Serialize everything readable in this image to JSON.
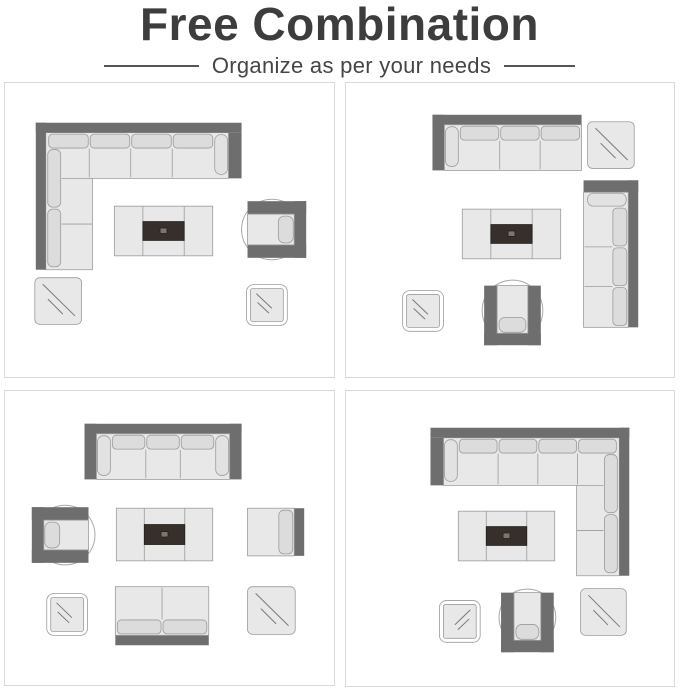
{
  "header": {
    "title": "Free Combination",
    "subtitle": "Organize as per your needs"
  },
  "colors": {
    "title": "#3d3d3d",
    "subtitle": "#454545",
    "divider": "#555555",
    "panel_border": "#d9d9d9",
    "background": "#ffffff",
    "frame_dark": "#6e6e6e",
    "seat_light": "#e8e8e8",
    "cushion_mid": "#dcdcdc",
    "arm_cushion": "#e2e2e2",
    "outline": "#9b9b9b",
    "circle_stroke": "#a8a8a8",
    "table_dark": "#362f2b",
    "table_dark_edge": "#242019",
    "table_icon": "#7d756c",
    "glass_line": "#7a7a7a"
  },
  "panels": [
    {
      "name": "layout-1",
      "items": [
        {
          "type": "sectional-sofa",
          "x": 31,
          "y": 40,
          "w": 207,
          "h": 148,
          "bodyH": 56,
          "legW": 57
        },
        {
          "type": "coffee-table",
          "x": 110,
          "y": 124,
          "w": 99,
          "h": 50
        },
        {
          "type": "armchair",
          "x": 244,
          "y": 119,
          "w": 59,
          "h": 57,
          "rot": 90
        },
        {
          "type": "side-table-large",
          "x": 30,
          "y": 196,
          "w": 47,
          "h": 47,
          "slope": "\\"
        },
        {
          "type": "side-table-small",
          "x": 243,
          "y": 203,
          "w": 41,
          "h": 41,
          "slope": "\\"
        }
      ]
    },
    {
      "name": "layout-2",
      "items": [
        {
          "type": "sofa",
          "x": 87,
          "y": 32,
          "w": 150,
          "h": 56,
          "seats": 3,
          "arms": "left"
        },
        {
          "type": "side-table-large",
          "x": 243,
          "y": 39,
          "w": 47,
          "h": 47,
          "slope": "\\"
        },
        {
          "type": "sofa",
          "x": 239,
          "y": 98,
          "w": 55,
          "h": 148,
          "seats": 3,
          "arms": "left",
          "rot": 90
        },
        {
          "type": "coffee-table",
          "x": 117,
          "y": 127,
          "w": 99,
          "h": 50
        },
        {
          "type": "armchair",
          "x": 139,
          "y": 204,
          "w": 57,
          "h": 60,
          "rot": 180
        },
        {
          "type": "side-table-small",
          "x": 57,
          "y": 209,
          "w": 41,
          "h": 41,
          "slope": "\\"
        }
      ]
    },
    {
      "name": "layout-3",
      "items": [
        {
          "type": "sofa",
          "x": 80,
          "y": 33,
          "w": 158,
          "h": 56,
          "seats": 3,
          "arms": "both"
        },
        {
          "type": "armchair",
          "x": 27,
          "y": 117,
          "w": 57,
          "h": 56,
          "rot": 270
        },
        {
          "type": "coffee-table",
          "x": 112,
          "y": 118,
          "w": 97,
          "h": 53
        },
        {
          "type": "armless-chair",
          "x": 244,
          "y": 118,
          "w": 57,
          "h": 48,
          "rot": 90
        },
        {
          "type": "side-table-small",
          "x": 42,
          "y": 204,
          "w": 41,
          "h": 42,
          "slope": "\\"
        },
        {
          "type": "loveseat",
          "x": 111,
          "y": 197,
          "w": 94,
          "h": 59,
          "seats": 2,
          "arms": "none",
          "rot": 180
        },
        {
          "type": "side-table-large",
          "x": 244,
          "y": 197,
          "w": 48,
          "h": 48,
          "slope": "\\"
        }
      ]
    },
    {
      "name": "layout-4",
      "items": [
        {
          "type": "sectional-sofa",
          "x": 85,
          "y": 37,
          "w": 200,
          "h": 149,
          "bodyH": 58,
          "legW": 53,
          "mirror": true
        },
        {
          "type": "coffee-table",
          "x": 113,
          "y": 121,
          "w": 97,
          "h": 50
        },
        {
          "type": "side-table-small",
          "x": 94,
          "y": 211,
          "w": 41,
          "h": 42,
          "slope": "/"
        },
        {
          "type": "armchair",
          "x": 156,
          "y": 203,
          "w": 53,
          "h": 60,
          "rot": 180
        },
        {
          "type": "side-table-large",
          "x": 236,
          "y": 199,
          "w": 46,
          "h": 47,
          "slope": "\\"
        }
      ]
    }
  ]
}
